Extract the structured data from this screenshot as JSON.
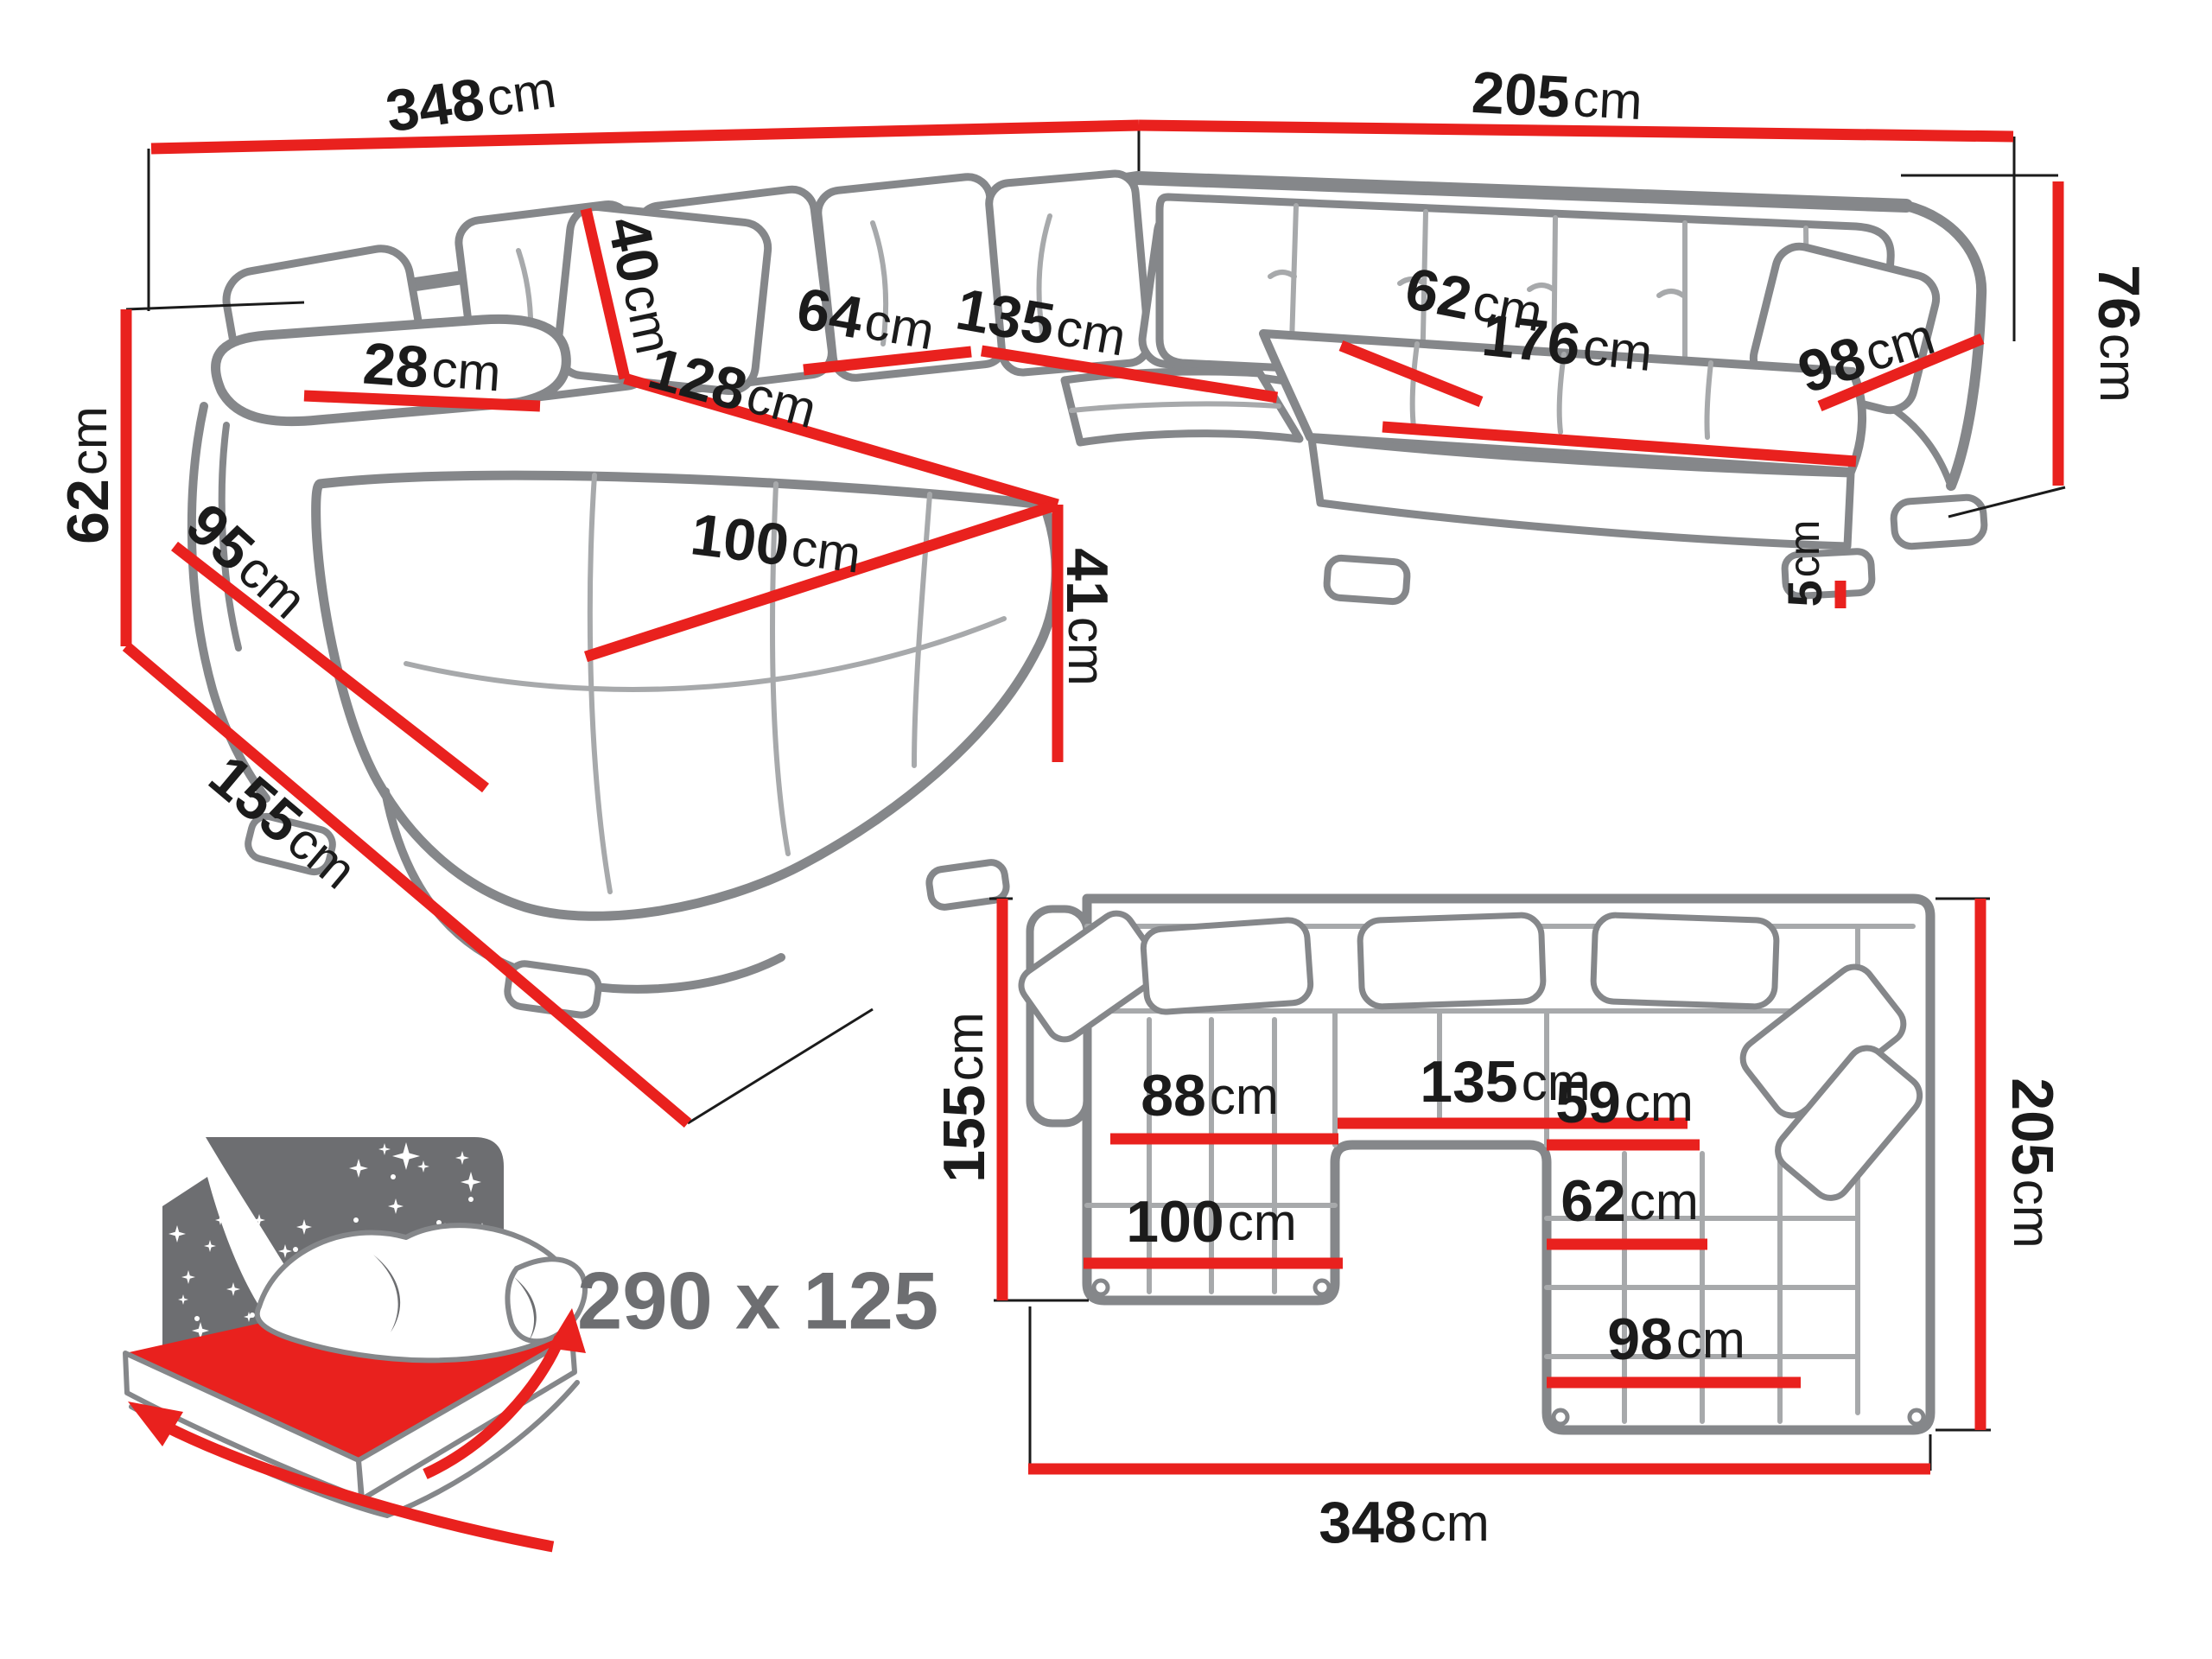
{
  "colors": {
    "accent_red": "#e9211e",
    "outline_gray": "#85878a",
    "icon_gray": "#6d6e71",
    "text_black": "#1b1b1b"
  },
  "perspective": {
    "dims": {
      "top_width": {
        "value": "348",
        "unit": "cm"
      },
      "right_width": {
        "value": "205",
        "unit": "cm"
      },
      "left_height": {
        "value": "62",
        "unit": "cm"
      },
      "right_height": {
        "value": "76",
        "unit": "cm"
      },
      "depth": {
        "value": "155",
        "unit": "cm"
      },
      "armrest_width": {
        "value": "28",
        "unit": "cm"
      },
      "arm_side_length": {
        "value": "95",
        "unit": "cm"
      },
      "back_cushion": {
        "value": "40",
        "unit": "cm"
      },
      "chaise_back": {
        "value": "64",
        "unit": "cm"
      },
      "middle_seat": {
        "value": "135",
        "unit": "cm"
      },
      "chaise_length": {
        "value": "128",
        "unit": "cm"
      },
      "chaise_width": {
        "value": "100",
        "unit": "cm"
      },
      "right_seat_depth": {
        "value": "62",
        "unit": "cm"
      },
      "right_seat_length": {
        "value": "176",
        "unit": "cm"
      },
      "right_end_width": {
        "value": "98",
        "unit": "cm"
      },
      "seat_height": {
        "value": "41",
        "unit": "cm"
      },
      "leg_height": {
        "value": "5",
        "unit": "cm"
      }
    }
  },
  "sleeping_area": {
    "size": "290 x 125"
  },
  "plan": {
    "dims": {
      "left_depth": {
        "value": "155",
        "unit": "cm"
      },
      "right_depth": {
        "value": "205",
        "unit": "cm"
      },
      "total_width": {
        "value": "348",
        "unit": "cm"
      },
      "middle_seat": {
        "value": "135",
        "unit": "cm"
      },
      "chaise_inner": {
        "value": "88",
        "unit": "cm"
      },
      "chaise_width": {
        "value": "100",
        "unit": "cm"
      },
      "right_seat_a": {
        "value": "59",
        "unit": "cm"
      },
      "right_seat_b": {
        "value": "62",
        "unit": "cm"
      },
      "right_end": {
        "value": "98",
        "unit": "cm"
      }
    }
  }
}
